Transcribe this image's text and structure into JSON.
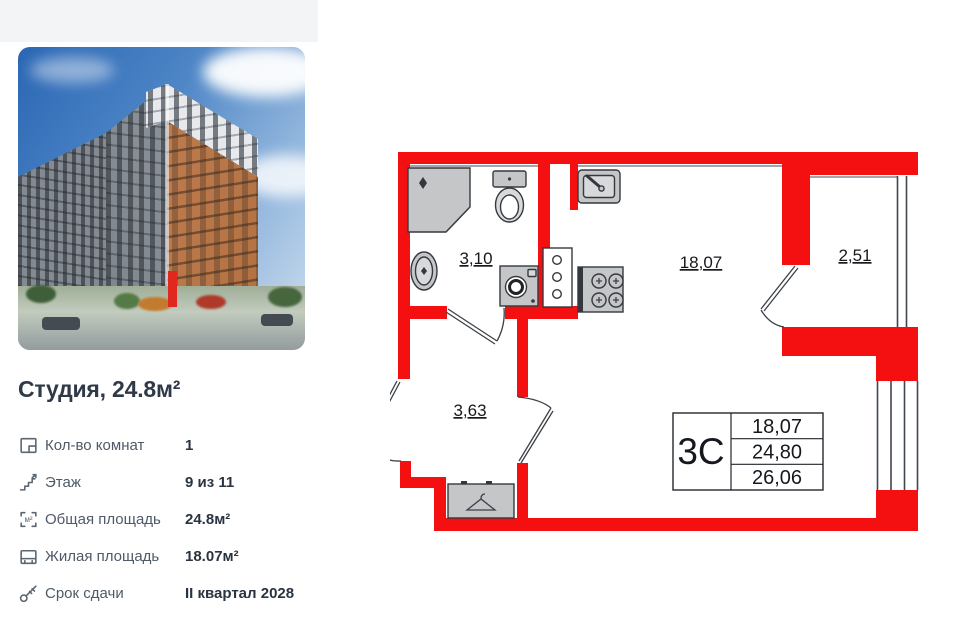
{
  "page": {
    "background": "#ffffff",
    "top_strip_color": "#f2f4f6"
  },
  "listing": {
    "title": "Студия, 24.8м²",
    "specs": [
      {
        "label": "Кол-во комнат",
        "value": "1"
      },
      {
        "label": "Этаж",
        "value": "9 из 11"
      },
      {
        "label": "Общая площадь",
        "value": "24.8м²"
      },
      {
        "label": "Жилая площадь",
        "value": "18.07м²"
      },
      {
        "label": "Срок сдачи",
        "value": "II квартал 2028"
      }
    ]
  },
  "icons": {
    "m2": "м²"
  },
  "floorplan": {
    "wall_color": "#f41010",
    "rooms": {
      "bathroom": "3,10",
      "living": "18,07",
      "balcony": "2,51",
      "hallway": "3,63"
    },
    "summary": {
      "code": "3С",
      "rows": [
        "18,07",
        "24,80",
        "26,06"
      ]
    }
  }
}
